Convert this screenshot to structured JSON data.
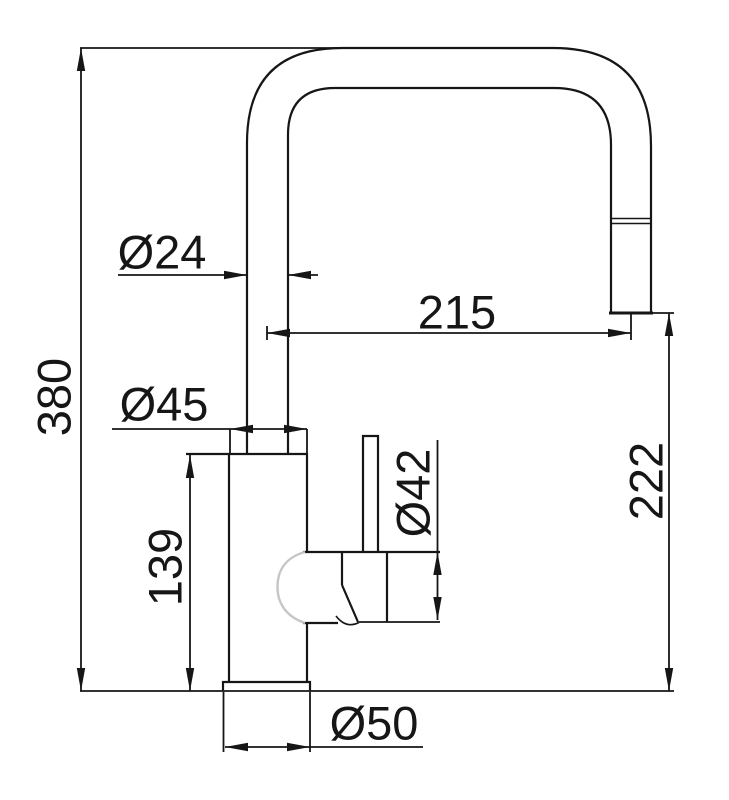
{
  "colors": {
    "line": "#161616",
    "background": "#ffffff",
    "highlight": "#c6c6c6"
  },
  "drawing": {
    "subject": "kitchen-faucet-dimension-drawing",
    "dimensions": {
      "total_height": "380",
      "spout_tube_diameter": "Ø24",
      "spout_reach": "215",
      "body_diameter": "Ø45",
      "body_height": "139",
      "valve_housing_diameter": "Ø42",
      "spout_clearance_height": "222",
      "base_diameter": "Ø50"
    }
  }
}
